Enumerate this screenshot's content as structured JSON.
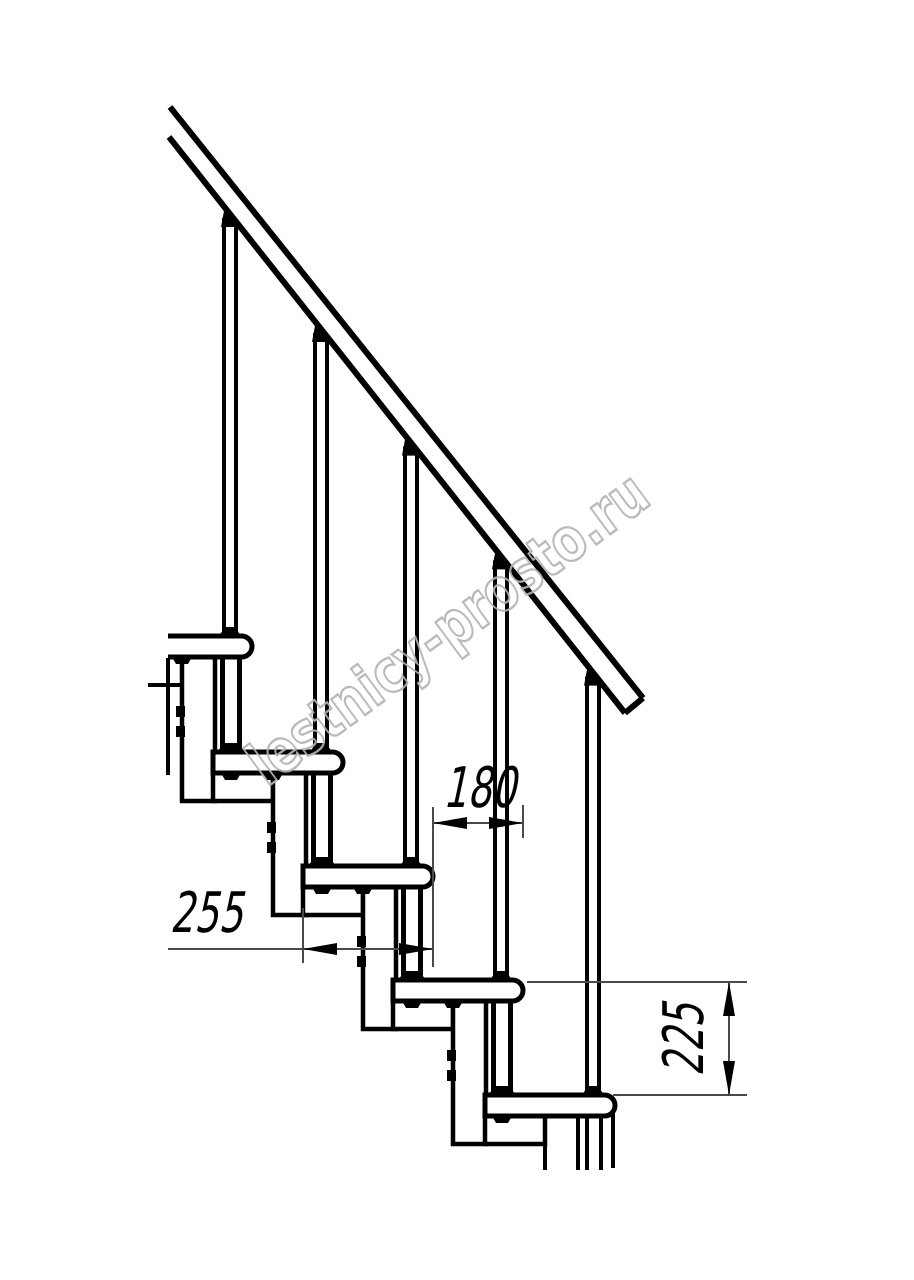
{
  "drawing": {
    "title_label": "staircase-side-elevation-drawing",
    "canvas": {
      "w": 914,
      "h": 1280,
      "bg": "#ffffff",
      "ink": "#000000",
      "dim_ink": "#4a4a4a"
    },
    "watermark": {
      "text": "lestnicy-prosto.ru",
      "color": "#b2b2b2",
      "angle_deg": -36.4,
      "cx": 460,
      "cy": 645,
      "font_size": 60,
      "text_length": 480,
      "stroke_width": 2.4
    },
    "rail": {
      "upper": {
        "x1": 170,
        "y1": 107,
        "x2": 643,
        "y2": 698
      },
      "lower": {
        "x1": 169,
        "y1": 137,
        "x2": 625,
        "y2": 713
      },
      "stroke": 6
    },
    "steps": [
      {
        "nose": 252,
        "top": 636
      },
      {
        "nose": 343,
        "top": 752
      },
      {
        "nose": 433,
        "top": 866
      },
      {
        "nose": 523,
        "top": 980
      },
      {
        "nose": 615,
        "top": 1095
      }
    ],
    "geometry": {
      "tread_len": 130,
      "tread_h": 21,
      "nose_r": 10.5,
      "stroke": 5,
      "module_stroke": 4.5,
      "wide_w": 60,
      "wide_h": 28,
      "narrow_w": 33,
      "bal_offset": 22,
      "bal_half": 6,
      "bal_stroke": 4,
      "post_offset": 21,
      "post_half": 8.5,
      "post_stroke": 5,
      "bolt_y_offsets": [
        49,
        69
      ],
      "bolt_w": 9,
      "bolt_h": 11,
      "arrow_len": 34,
      "arrow_halfwidth": 6,
      "dim_stroke": 2,
      "dim_font_size": 56,
      "dim_scale_x": 0.68,
      "dim_skew_deg": -12
    },
    "cut_lines": [
      [
        168,
        658,
        168,
        775
      ],
      [
        148,
        685,
        182,
        685
      ],
      [
        613,
        1113,
        613,
        1168
      ],
      [
        545,
        1116,
        545,
        1170
      ],
      [
        578,
        1116,
        578,
        1170
      ],
      [
        587,
        1116,
        587,
        1170
      ],
      [
        601,
        1116,
        601,
        1170
      ]
    ],
    "dimensions": [
      {
        "label": "180",
        "line": [
          433,
          823,
          523,
          823
        ],
        "arrows": [
          {
            "x": 433,
            "y": 823,
            "dir": "left"
          },
          {
            "x": 523,
            "y": 823,
            "dir": "right"
          }
        ],
        "exts": [
          [
            433,
            807,
            433,
            967
          ],
          [
            523,
            805,
            523,
            838
          ]
        ],
        "text": {
          "x": 479,
          "y": 807,
          "rotate": 0
        }
      },
      {
        "label": "255",
        "line": [
          168,
          949,
          433,
          949
        ],
        "arrows": [
          {
            "x": 303,
            "y": 949,
            "dir": "left"
          },
          {
            "x": 433,
            "y": 949,
            "dir": "right"
          }
        ],
        "exts": [
          [
            303,
            908,
            303,
            963
          ]
        ],
        "text": {
          "x": 206,
          "y": 932,
          "rotate": 0
        }
      },
      {
        "label": "225",
        "line": [
          729,
          982,
          729,
          1095
        ],
        "arrows": [
          {
            "x": 729,
            "y": 982,
            "dir": "up"
          },
          {
            "x": 729,
            "y": 1095,
            "dir": "down"
          }
        ],
        "exts": [
          [
            527,
            982,
            747,
            982
          ],
          [
            613,
            1095,
            747,
            1095
          ]
        ],
        "text": {
          "x": 703,
          "y": 1040,
          "rotate": -90
        }
      }
    ]
  }
}
